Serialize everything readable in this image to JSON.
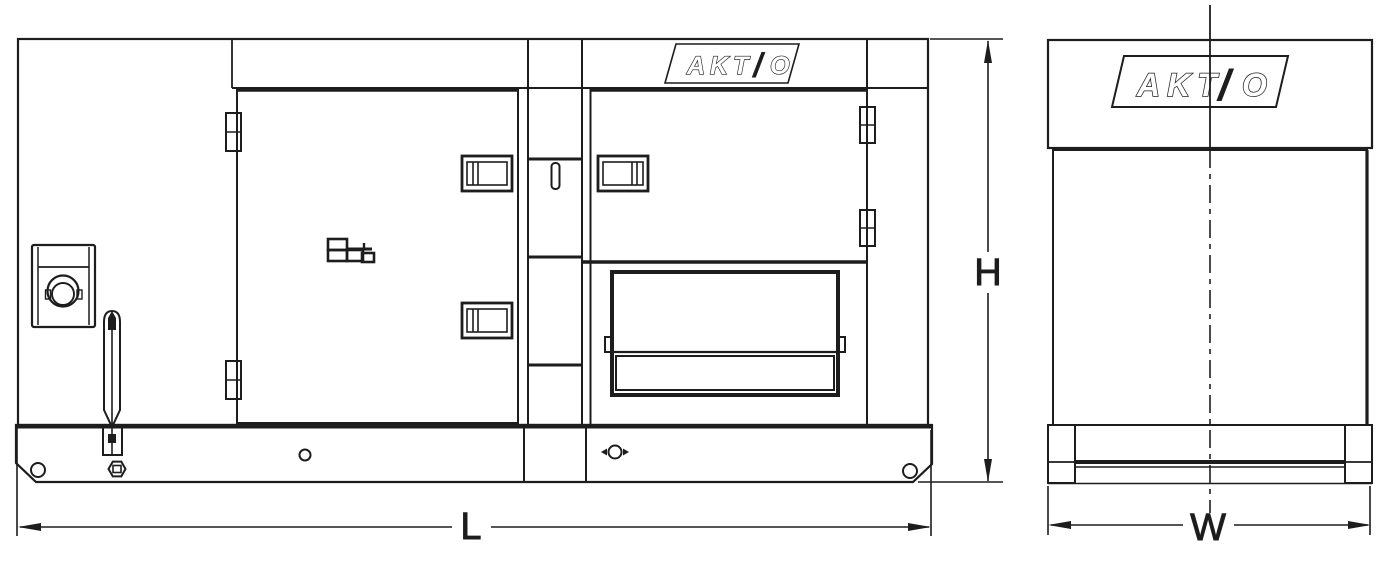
{
  "dimension_labels": {
    "height": "H",
    "length": "L",
    "width": "W"
  },
  "logo": {
    "letters": "AKT",
    "slash": "/",
    "o": "O",
    "full_text": "AKT/O"
  },
  "colors": {
    "line": "#1d1d1d",
    "background": "#ffffff"
  }
}
